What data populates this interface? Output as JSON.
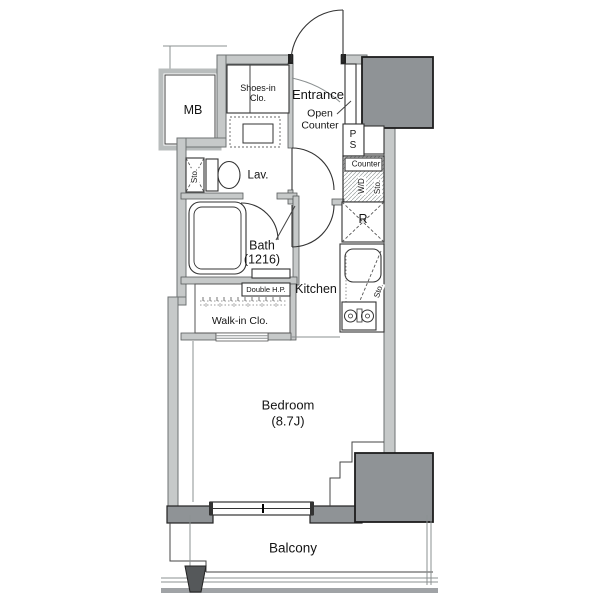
{
  "labels": {
    "mb": "MB",
    "shoes_closet_line1": "Shoes-in",
    "shoes_closet_line2": "Clo.",
    "entrance": "Entrance",
    "open_counter_line1": "Open",
    "open_counter_line2": "Counter",
    "ps_line1": "P",
    "ps_line2": "S",
    "counter": "Counter",
    "washer_dryer": "W/D",
    "washer_dryer_storage": "Sto.",
    "lavatory": "Lav.",
    "lavatory_storage": "Sto.",
    "bath_name": "Bath",
    "bath_size": "(1216)",
    "refrigerator": "R",
    "kitchen": "Kitchen",
    "kitchen_storage": "Sto.",
    "double_hanger_pipe": "Double H.P.",
    "walk_in_closet": "Walk-in Clo.",
    "bedroom_name": "Bedroom",
    "bedroom_size": "(8.7J)",
    "balcony": "Balcony"
  },
  "colors": {
    "background": "#ffffff",
    "wall_fill": "#c6c9c9",
    "column_fill": "#8f9396",
    "partition_fill": "#55585a",
    "outline": "#333333"
  }
}
